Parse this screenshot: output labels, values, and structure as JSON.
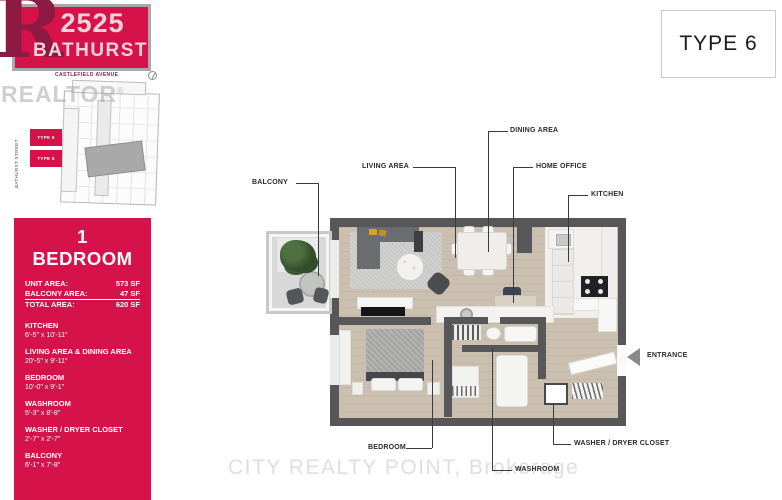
{
  "title_box": {
    "number": "2525",
    "name": "BATHURST"
  },
  "type_badge": "TYPE 6",
  "site_plan": {
    "street_top": "CASTLEFIELD AVENUE",
    "street_left": "BATHURST STREET",
    "unit_markers": [
      "TYPE 6",
      "TYPE 6"
    ]
  },
  "watermarks": {
    "realtor": "REALTOR",
    "brokerage": "CITY REALTY POINT, Brokerage"
  },
  "unit_panel": {
    "title": "1 BEDROOM",
    "areas": [
      {
        "label": "UNIT AREA:",
        "value": "573 SF"
      },
      {
        "label": "BALCONY AREA:",
        "value": "47 SF"
      },
      {
        "label": "TOTAL AREA:",
        "value": "620 SF"
      }
    ],
    "rooms": [
      {
        "name": "KITCHEN",
        "dims": "6'-5\" x 10'-11\""
      },
      {
        "name": "LIVING AREA & DINING AREA",
        "dims": "20'-5\" x 9'-11\""
      },
      {
        "name": "BEDROOM",
        "dims": "10'-0\" x 9'-1\""
      },
      {
        "name": "WASHROOM",
        "dims": "5'-3\" x 8'-8\""
      },
      {
        "name": "WASHER / DRYER CLOSET",
        "dims": "2'-7\" x 2'-7\""
      },
      {
        "name": "BALCONY",
        "dims": "6'-1\" x 7'-8\""
      }
    ]
  },
  "plan_labels": {
    "balcony": "BALCONY",
    "living": "LIVING AREA",
    "dining": "DINING AREA",
    "home_office": "HOME OFFICE",
    "kitchen": "KITCHEN",
    "entrance": "ENTRANCE",
    "bedroom": "BEDROOM",
    "washroom": "WASHROOM",
    "washer_dryer": "WASHER / DRYER CLOSET"
  },
  "colors": {
    "brand_red": "#D6124B",
    "logo_dark_red": "#8D1A42",
    "wall_gray": "#57575A",
    "floor_beige": "#CBC0B0"
  }
}
